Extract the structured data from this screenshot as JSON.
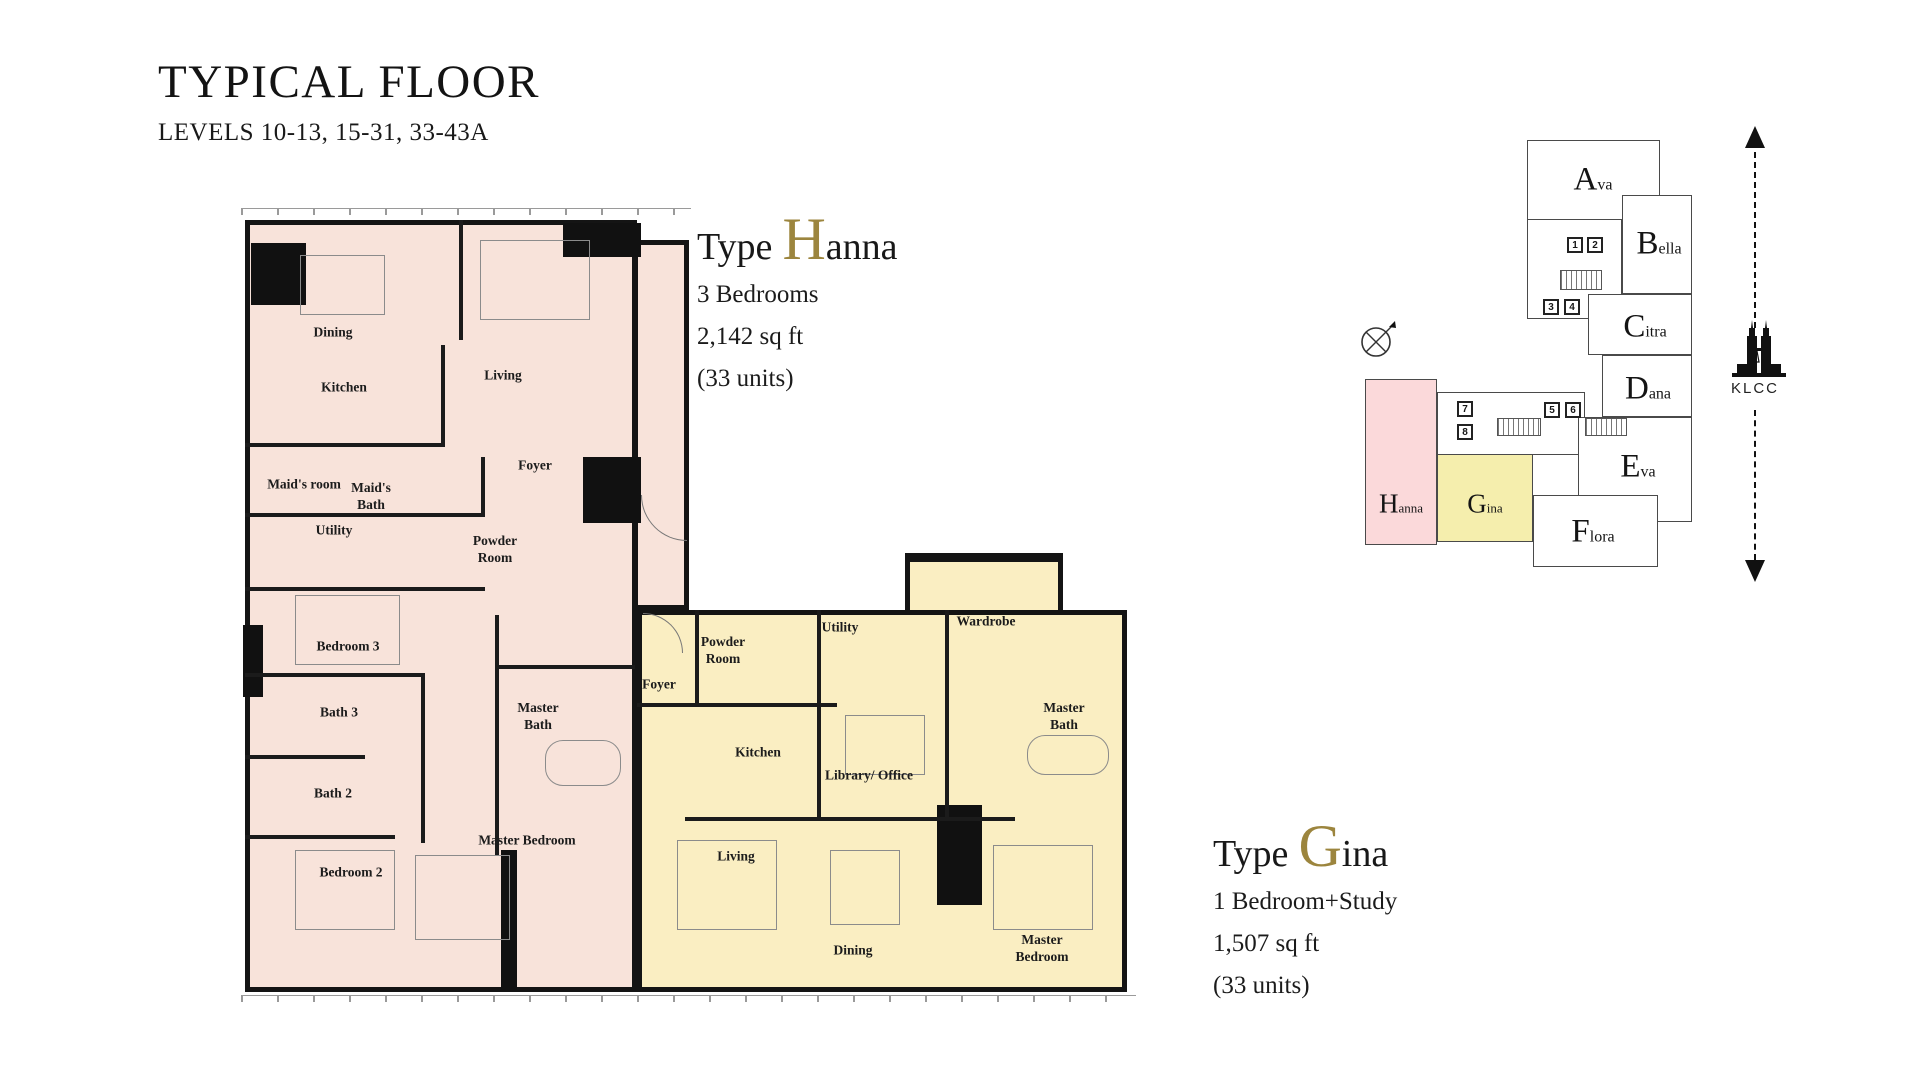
{
  "header": {
    "title": "TYPICAL FLOOR",
    "subtitle": "LEVELS 10-13, 15-31, 33-43A"
  },
  "types": {
    "hanna": {
      "prefix": "Type",
      "initial": "H",
      "rest": "anna",
      "spec": "3 Bedrooms",
      "area": "2,142 sq ft",
      "units": "(33 units)"
    },
    "gina": {
      "prefix": "Type",
      "initial": "G",
      "rest": "ina",
      "spec": "1 Bedroom+Study",
      "area": "1,507 sq ft",
      "units": "(33 units)"
    }
  },
  "colors": {
    "accent_gold": "#9c853e",
    "hanna_fill": "#f8e3da",
    "gina_fill": "#faeec2",
    "keyplan_hanna_fill": "#fbd9da",
    "keyplan_gina_fill": "#f5eead",
    "wall": "#141414"
  },
  "floorplan": {
    "units": [
      {
        "id": "hanna",
        "name": "Hanna",
        "rooms": [
          {
            "label": "Dining",
            "x": 88,
            "y": 138
          },
          {
            "label": "Kitchen",
            "x": 99,
            "y": 193
          },
          {
            "label": "Living",
            "x": 258,
            "y": 181
          },
          {
            "label": "Maid's room",
            "x": 59,
            "y": 290
          },
          {
            "label": "Maid's\nBath",
            "x": 126,
            "y": 302
          },
          {
            "label": "Utility",
            "x": 89,
            "y": 336
          },
          {
            "label": "Foyer",
            "x": 290,
            "y": 271
          },
          {
            "label": "Powder\nRoom",
            "x": 250,
            "y": 355
          },
          {
            "label": "Bedroom 3",
            "x": 103,
            "y": 452
          },
          {
            "label": "Bath 3",
            "x": 94,
            "y": 518
          },
          {
            "label": "Bath 2",
            "x": 88,
            "y": 599
          },
          {
            "label": "Master\nBath",
            "x": 293,
            "y": 522
          },
          {
            "label": "Bedroom 2",
            "x": 106,
            "y": 678
          },
          {
            "label": "Master Bedroom",
            "x": 282,
            "y": 646
          }
        ]
      },
      {
        "id": "gina",
        "name": "Gina",
        "rooms": [
          {
            "label": "Powder\nRoom",
            "x": 478,
            "y": 456
          },
          {
            "label": "Foyer",
            "x": 414,
            "y": 490
          },
          {
            "label": "Utility",
            "x": 595,
            "y": 433
          },
          {
            "label": "Wardrobe",
            "x": 741,
            "y": 427
          },
          {
            "label": "Kitchen",
            "x": 513,
            "y": 558
          },
          {
            "label": "Library/ Office",
            "x": 624,
            "y": 581
          },
          {
            "label": "Master\nBath",
            "x": 819,
            "y": 522
          },
          {
            "label": "Living",
            "x": 491,
            "y": 662
          },
          {
            "label": "Dining",
            "x": 608,
            "y": 756
          },
          {
            "label": "Master Bedroom",
            "x": 797,
            "y": 754
          }
        ]
      }
    ]
  },
  "keyplan": {
    "units": [
      {
        "name": "Ava",
        "initial": "A",
        "rest": "va",
        "block": [
          182,
          28,
          133,
          80
        ],
        "label": [
          248,
          68
        ],
        "fill": "#ffffff",
        "mini": false
      },
      {
        "name": "Bella",
        "initial": "B",
        "rest": "ella",
        "block": [
          277,
          83,
          70,
          99
        ],
        "label": [
          314,
          132
        ],
        "fill": "#ffffff",
        "mini": false
      },
      {
        "name": "Citra",
        "initial": "C",
        "rest": "itra",
        "block": [
          243,
          182,
          104,
          61
        ],
        "label": [
          300,
          215
        ],
        "fill": "#ffffff",
        "mini": false
      },
      {
        "name": "Dana",
        "initial": "D",
        "rest": "ana",
        "block": [
          257,
          243,
          90,
          62
        ],
        "label": [
          303,
          277
        ],
        "fill": "#ffffff",
        "mini": false
      },
      {
        "name": "Eva",
        "initial": "E",
        "rest": "va",
        "block": [
          233,
          305,
          114,
          105
        ],
        "label": [
          293,
          355
        ],
        "fill": "#ffffff",
        "mini": false
      },
      {
        "name": "Flora",
        "initial": "F",
        "rest": "lora",
        "block": [
          188,
          383,
          125,
          72
        ],
        "label": [
          248,
          420
        ],
        "fill": "#ffffff",
        "mini": false
      },
      {
        "name": "Hanna",
        "initial": "H",
        "rest": "anna",
        "block": [
          20,
          267,
          72,
          166
        ],
        "label": [
          56,
          392
        ],
        "fill": "#fbd9da",
        "mini": true
      },
      {
        "name": "Gina",
        "initial": "G",
        "rest": "ina",
        "block": [
          92,
          342,
          96,
          88
        ],
        "label": [
          140,
          392
        ],
        "fill": "#f5eead",
        "mini": true
      }
    ],
    "cores": [
      [
        182,
        107,
        95,
        100
      ],
      [
        92,
        280,
        148,
        63
      ]
    ],
    "lifts": [
      {
        "n": "1",
        "x": 230,
        "y": 133
      },
      {
        "n": "2",
        "x": 250,
        "y": 133
      },
      {
        "n": "3",
        "x": 206,
        "y": 195
      },
      {
        "n": "4",
        "x": 227,
        "y": 195
      },
      {
        "n": "5",
        "x": 207,
        "y": 298
      },
      {
        "n": "6",
        "x": 228,
        "y": 298
      },
      {
        "n": "7",
        "x": 120,
        "y": 297
      },
      {
        "n": "8",
        "x": 120,
        "y": 320
      }
    ],
    "klcc_label": "KLCC"
  }
}
